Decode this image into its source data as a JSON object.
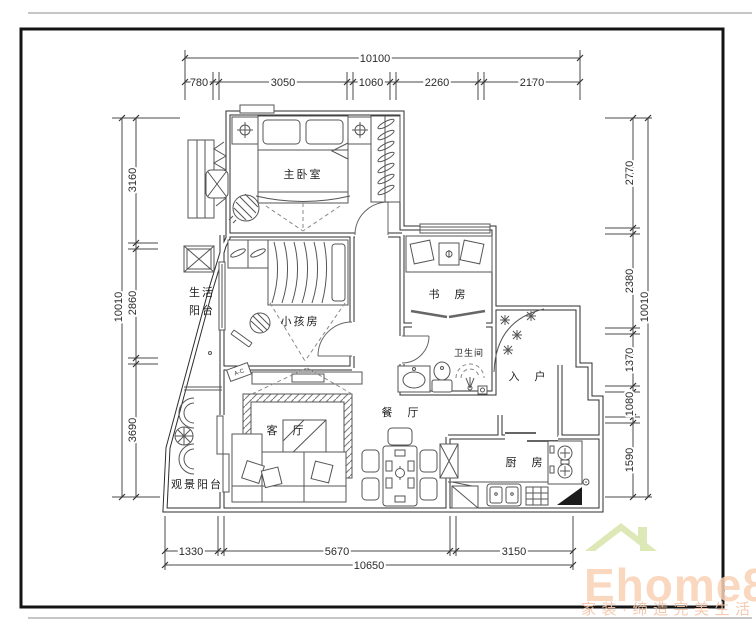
{
  "rooms": {
    "master_bedroom": "主卧室",
    "life_balcony_line1": "生活",
    "life_balcony_line2": "阳台",
    "kids_room": "小孩房",
    "study": "书 房",
    "bathroom": "卫生间",
    "entry": "入 户",
    "dining": "餐 厅",
    "living": "客 厅",
    "view_balcony": "观景阳台",
    "kitchen": "厨 房"
  },
  "dimensions": {
    "top": {
      "total": "10100",
      "segments": [
        "780",
        "3050",
        "1060",
        "2260",
        "2170"
      ]
    },
    "left": {
      "total": "10010",
      "segments": [
        "3160",
        "2860",
        "3690"
      ]
    },
    "right": {
      "total": "10010",
      "segments": [
        "2770",
        "2380",
        "1370",
        "1080",
        "1590"
      ]
    },
    "bottom": {
      "total": "10650",
      "segments": [
        "1330",
        "5670",
        "3150"
      ]
    }
  },
  "annotations": {
    "tag": "A-C"
  },
  "watermark": {
    "brand": "Ehome8",
    "tagline": "家装·缔造完美生活",
    "brand_color": "#f8d2b4",
    "tagline_color": "#f3c5a8",
    "roof_color": "#d9e6ae"
  }
}
